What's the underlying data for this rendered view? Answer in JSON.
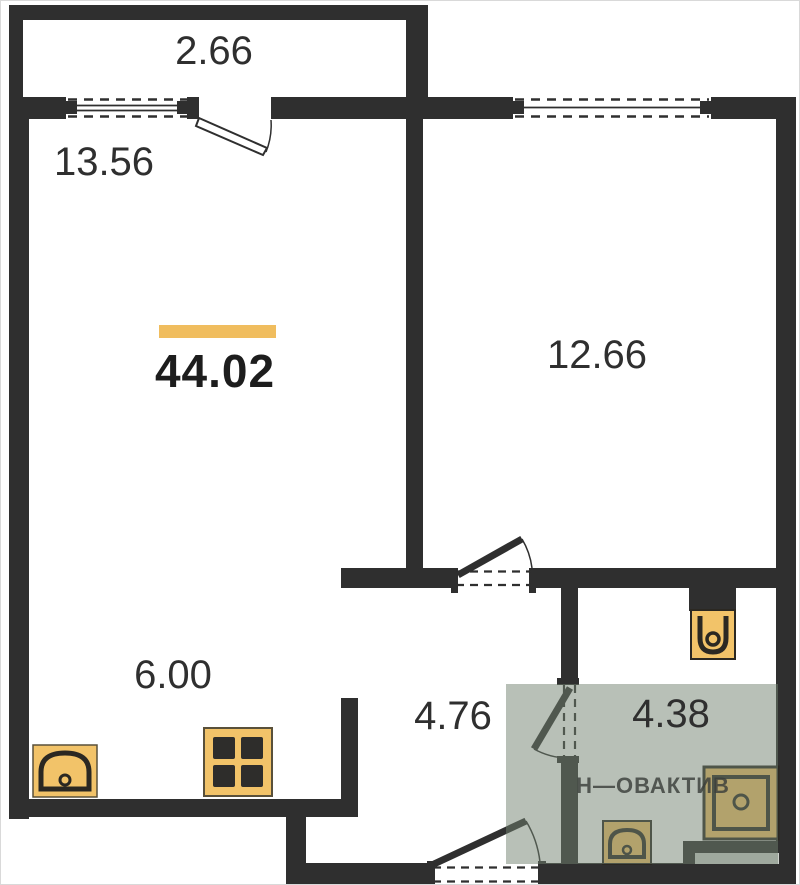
{
  "floor_plan": {
    "total_area": {
      "value": "44.02"
    },
    "rooms": {
      "balcony": {
        "area": "2.66"
      },
      "living_room": {
        "area": "13.56"
      },
      "bedroom": {
        "area": "12.66"
      },
      "kitchen": {
        "area": "6.00"
      },
      "hallway": {
        "area": "4.76"
      },
      "bathroom": {
        "area": "4.38",
        "highlighted": true
      }
    },
    "watermark": "Н—ОВАКТИВ",
    "fixtures": [
      "kitchen-sink",
      "stove",
      "toilet",
      "bathroom-sink",
      "shower-cabin"
    ],
    "colors": {
      "wall": "#2f2f2f",
      "fixture_fill": "#f2c369",
      "accent_bar": "#f0bd5e",
      "bathroom_highlight": "#71816f"
    }
  }
}
